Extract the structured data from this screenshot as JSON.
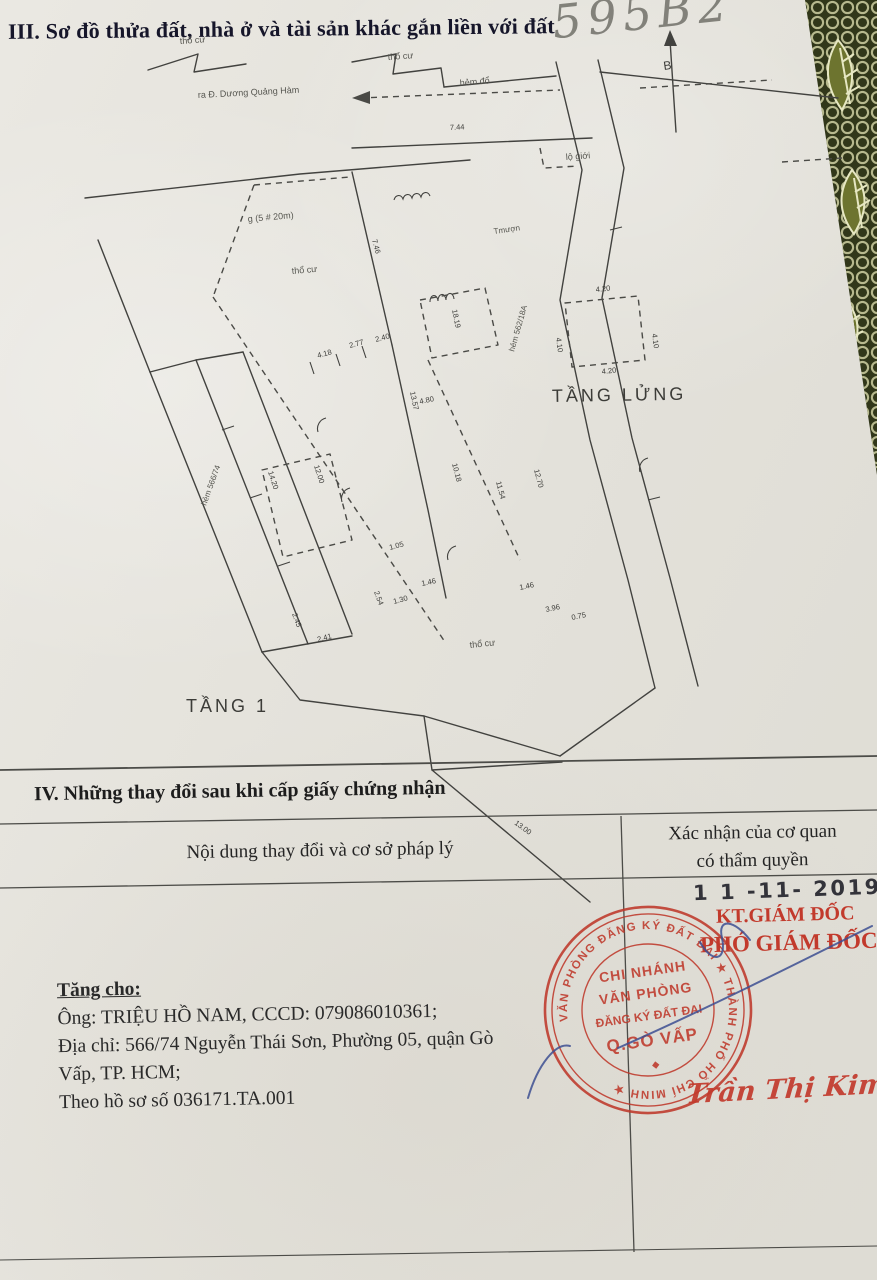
{
  "document": {
    "section3_title": "III. Sơ đồ thửa đất, nhà ở và tài sản khác gắn liền với đất",
    "handwritten_number": "595B2",
    "north_label": "B"
  },
  "diagram": {
    "text_labels": [
      {
        "t": "thổ cư",
        "x": 180,
        "y": 44,
        "r": -4,
        "s": 9
      },
      {
        "t": "thổ cư",
        "x": 388,
        "y": 60,
        "r": -4,
        "s": 9
      },
      {
        "t": "ra Đ. Dương Quảng Hàm",
        "x": 198,
        "y": 98,
        "r": -3,
        "s": 9
      },
      {
        "t": "hẻm đổ",
        "x": 460,
        "y": 86,
        "r": -5,
        "s": 9
      },
      {
        "t": "lộ giới",
        "x": 566,
        "y": 160,
        "r": -4,
        "s": 9
      },
      {
        "t": "thổ cư",
        "x": 292,
        "y": 274,
        "r": -5,
        "s": 9
      },
      {
        "t": "g (5 # 20m)",
        "x": 248,
        "y": 222,
        "r": -5,
        "s": 9
      },
      {
        "t": "Tmượn",
        "x": 494,
        "y": 234,
        "r": -8,
        "s": 8
      },
      {
        "t": "hẻm 562/18A",
        "x": 514,
        "y": 352,
        "r": -74,
        "s": 8
      },
      {
        "t": "hẻm 566/74",
        "x": 206,
        "y": 506,
        "r": -70,
        "s": 8
      },
      {
        "t": "thổ cư",
        "x": 470,
        "y": 648,
        "r": -6,
        "s": 9
      },
      {
        "t": "TẦNG LỬNG",
        "x": 552,
        "y": 402,
        "r": -1,
        "s": 18
      },
      {
        "t": "TẦNG 1",
        "x": 186,
        "y": 712,
        "r": 0,
        "s": 18
      }
    ],
    "dim_labels": [
      {
        "t": "7.44",
        "x": 450,
        "y": 130,
        "r": -3
      },
      {
        "t": "4.20",
        "x": 596,
        "y": 292,
        "r": -6
      },
      {
        "t": "4.20",
        "x": 602,
        "y": 374,
        "r": -6
      },
      {
        "t": "4.10",
        "x": 556,
        "y": 338,
        "r": 82
      },
      {
        "t": "4.10",
        "x": 652,
        "y": 334,
        "r": 82
      },
      {
        "t": "18.19",
        "x": 452,
        "y": 310,
        "r": 78
      },
      {
        "t": "13.57",
        "x": 410,
        "y": 392,
        "r": 78
      },
      {
        "t": "14.20",
        "x": 268,
        "y": 472,
        "r": 72
      },
      {
        "t": "12.00",
        "x": 314,
        "y": 466,
        "r": 72
      },
      {
        "t": "10.18",
        "x": 452,
        "y": 464,
        "r": 75
      },
      {
        "t": "11.54",
        "x": 496,
        "y": 482,
        "r": 75
      },
      {
        "t": "12.70",
        "x": 534,
        "y": 470,
        "r": 75
      },
      {
        "t": "4.80",
        "x": 420,
        "y": 404,
        "r": -12
      },
      {
        "t": "2.77",
        "x": 350,
        "y": 348,
        "r": -15
      },
      {
        "t": "2.40",
        "x": 376,
        "y": 342,
        "r": -15
      },
      {
        "t": "4.18",
        "x": 318,
        "y": 358,
        "r": -15
      },
      {
        "t": "7.46",
        "x": 372,
        "y": 240,
        "r": 75
      },
      {
        "t": "1.05",
        "x": 390,
        "y": 550,
        "r": -15
      },
      {
        "t": "2.54",
        "x": 374,
        "y": 592,
        "r": 70
      },
      {
        "t": "1.30",
        "x": 394,
        "y": 604,
        "r": -15
      },
      {
        "t": "3.96",
        "x": 546,
        "y": 612,
        "r": -12
      },
      {
        "t": "0.75",
        "x": 572,
        "y": 620,
        "r": -12
      },
      {
        "t": "1.46",
        "x": 422,
        "y": 586,
        "r": -12
      },
      {
        "t": "1.46",
        "x": 520,
        "y": 590,
        "r": -12
      },
      {
        "t": "2.45",
        "x": 292,
        "y": 614,
        "r": 70
      },
      {
        "t": "2.41",
        "x": 318,
        "y": 642,
        "r": -15
      },
      {
        "t": "13.00",
        "x": 514,
        "y": 824,
        "r": 36
      }
    ]
  },
  "section4": {
    "title": "IV. Những thay đổi sau khi cấp giấy chứng nhận",
    "col_left_header": "Nội dung thay đổi và cơ sở pháp lý",
    "col_right_header_1": "Xác nhận của cơ quan",
    "col_right_header_2": "có thẩm quyền",
    "content": {
      "heading": "Tăng cho:",
      "line1": "Ông: TRIỆU HỒ NAM, CCCD: 079086010361;",
      "line2": "Địa chỉ: 566/74 Nguyễn Thái Sơn, Phường 05, quận Gò",
      "line3": "Vấp, TP. HCM;",
      "line4": "Theo hồ sơ số 036171.TA.001"
    },
    "approval": {
      "date_stamp": "1 1 -11- 2019",
      "kt_line": "KT.GIÁM ĐỐC",
      "pho_line": "PHÓ GIÁM ĐỐC",
      "stamp": {
        "ring_text": "VĂN PHÒNG ĐĂNG KÝ ĐẤT ĐAI ★ THÀNH PHỐ HỒ CHÍ MINH ★",
        "center_line1": "CHI NHÁNH",
        "center_line2": "VĂN PHÒNG",
        "center_line3": "ĐĂNG KÝ ĐẤT ĐAI",
        "center_line4": "Q.GÒ VẤP",
        "diamond": "◆"
      },
      "signature_name": "Trần Thị Kim Tịnh"
    }
  },
  "colors": {
    "stamp_red": "#bf392b",
    "pen_blue": "#3d4f92",
    "ink": "#42423f",
    "paper": "#e6e3dc",
    "lace_background": "#31371a",
    "lace_thread": "#d2d3a6"
  }
}
